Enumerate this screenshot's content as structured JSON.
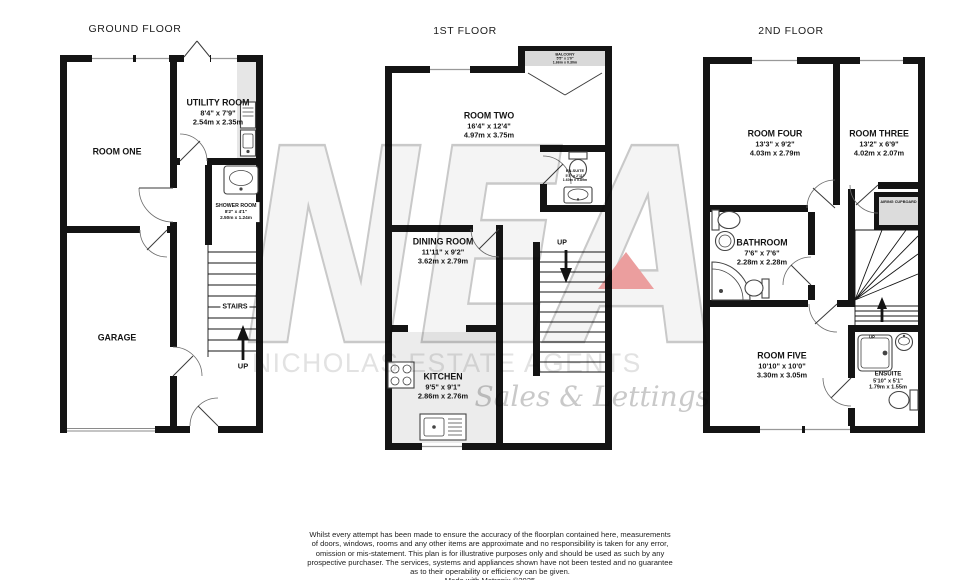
{
  "titles": {
    "ground": "GROUND FLOOR",
    "first": "1ST FLOOR",
    "second": "2ND FLOOR"
  },
  "floors": {
    "ground": {
      "room_one": {
        "name": "ROOM ONE"
      },
      "utility": {
        "name": "UTILITY ROOM",
        "imperial": "8'4\" x 7'9\"",
        "metric": "2.54m x 2.35m"
      },
      "shower": {
        "name": "SHOWER ROOM",
        "imperial": "8'2\" x 4'1\"",
        "metric": "2.50m x 1.24m"
      },
      "garage": {
        "name": "GARAGE"
      },
      "stairs_label": "STAIRS",
      "up_label": "UP"
    },
    "first": {
      "room_two": {
        "name": "ROOM TWO",
        "imperial": "16'4\" x 12'4\"",
        "metric": "4.97m x 3.75m"
      },
      "balcony": {
        "name": "BALCONY",
        "imperial": "5'5\" x 1'0\"",
        "metric": "1.66m x 0.30m"
      },
      "ensuite": {
        "name": "EN-SUITE",
        "imperial": "5'3\" x 2'11\"",
        "metric": "1.60m x 0.89m"
      },
      "dining": {
        "name": "DINING ROOM",
        "imperial": "11'11\" x 9'2\"",
        "metric": "3.62m x 2.79m"
      },
      "kitchen": {
        "name": "KITCHEN",
        "imperial": "9'5\" x 9'1\"",
        "metric": "2.86m x 2.76m"
      },
      "up_label": "UP"
    },
    "second": {
      "room_four": {
        "name": "ROOM FOUR",
        "imperial": "13'3\" x 9'2\"",
        "metric": "4.03m x 2.79m"
      },
      "room_three": {
        "name": "ROOM THREE",
        "imperial": "13'2\" x 6'9\"",
        "metric": "4.02m x 2.07m"
      },
      "bathroom": {
        "name": "BATHROOM",
        "imperial": "7'6\" x 7'6\"",
        "metric": "2.28m x 2.28m"
      },
      "airing": {
        "name": "AIRING CUPBOARD"
      },
      "room_five": {
        "name": "ROOM FIVE",
        "imperial": "10'10\" x 10'0\"",
        "metric": "3.30m x 3.05m"
      },
      "ensuite": {
        "name": "ENSUITE",
        "imperial": "5'10\" x 5'1\"",
        "metric": "1.79m x 1.55m"
      },
      "up_label": "UP"
    }
  },
  "watermark": {
    "initials": "NEA",
    "name": "NICHOLAS ESTATE AGENTS",
    "tagline": "Sales & Lettings",
    "accent_color": "#eb9e9e",
    "gray_color": "#c9c9c9"
  },
  "disclaimer": {
    "line1": "Whilst every attempt has been made to ensure the accuracy of the floorplan contained here, measurements",
    "line2": "of doors, windows, rooms and any other items are approximate and no responsibility is taken for any error,",
    "line3": "omission or mis-statement. This plan is for illustrative purposes only and should be used as such by any",
    "line4": "prospective purchaser. The services, systems and appliances shown have not been tested and no guarantee",
    "line5": "as to their operability or efficiency can be given.",
    "line6": "Made with Metropix ©2025"
  }
}
